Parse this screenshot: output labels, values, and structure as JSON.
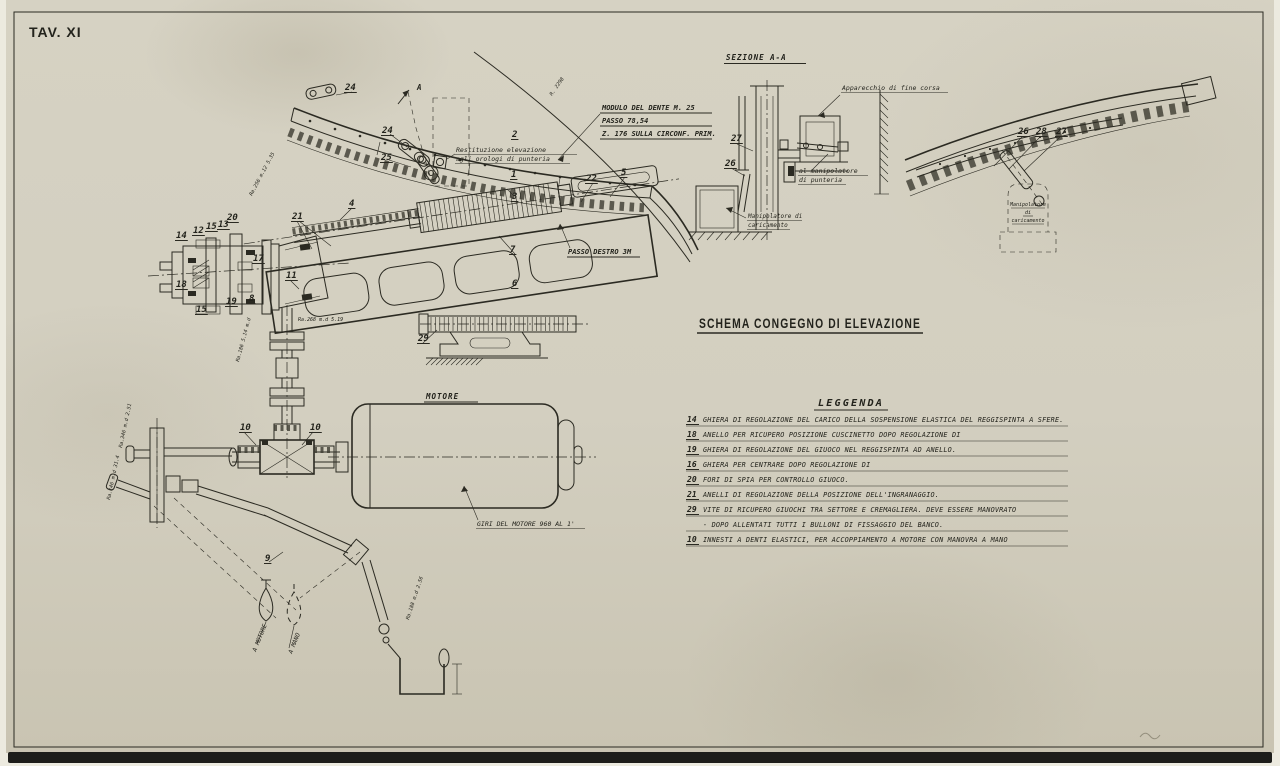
{
  "sheet_label": "TAV. XI",
  "title": "SCHEMA CONGEGNO DI ELEVAZIONE",
  "colors": {
    "paper": "#d3cfc0",
    "ink": "#2b2a22",
    "shadow": "#1d1d1a"
  },
  "gear_notes": {
    "line1": "MODULO DEL DENTE  M. 25",
    "line2": "PASSO 78,54",
    "line3": "Z. 176 SULLA CIRCONF. PRIM.",
    "radius": "R. 2298"
  },
  "labels": {
    "sezione": "SEZIONE A-A",
    "apparecchio": "Apparecchio di fine corsa",
    "al_manipolatore_1": "al manipolatore",
    "al_manipolatore_2": "di punteria",
    "manip_caric_1": "Manipolatore di",
    "manip_caric_2": "caricamento",
    "manip_right_1": "Manipolatore",
    "manip_right_2": "di",
    "manip_right_3": "caricamento",
    "restituzione_1": "Restituzione elevazione",
    "restituzione_2": "agli orologi di punteria",
    "motore": "MOTORE",
    "giri_motore": "GIRI DEL MOTORE 960 AL 1'",
    "passo_destro": "PASSO DESTRO 3M",
    "section_arrow": "A",
    "a_motore": "A MOTORE",
    "a_mano": "A MANO"
  },
  "legend": {
    "heading": "LEGGENDA",
    "items": [
      {
        "num": "14",
        "lines": [
          "GHIERA DI REGOLAZIONE DEL CARICO DELLA SOSPENSIONE ELASTICA DEL REGGISPINTA A SFERE."
        ]
      },
      {
        "num": "18",
        "lines": [
          "ANELLO PER RICUPERO POSIZIONE CUSCINETTO DOPO REGOLAZIONE DI"
        ]
      },
      {
        "num": "19",
        "lines": [
          "GHIERA DI REGOLAZIONE DEL GIUOCO NEL REGGISPINTA AD ANELLO."
        ]
      },
      {
        "num": "16",
        "lines": [
          "GHIERA PER CENTRARE  DOPO REGOLAZIONE DI"
        ]
      },
      {
        "num": "20",
        "lines": [
          "FORI DI SPIA PER CONTROLLO GIUOCO."
        ]
      },
      {
        "num": "21",
        "lines": [
          "ANELLI DI REGOLAZIONE DELLA POSIZIONE DELL'INGRANAGGIO."
        ]
      },
      {
        "num": "29",
        "lines": [
          "VITE DI RICUPERO GIUOCHI TRA SETTORE E CREMAGLIERA. DEVE ESSERE MANOVRATO",
          "- DOPO ALLENTATI TUTTI I BULLONI DI FISSAGGIO DEL BANCO."
        ]
      },
      {
        "num": "10",
        "lines": [
          "INNESTI A DENTI ELASTICI, PER ACCOPPIAMENTO A MOTORE CON MANOVRA A MANO"
        ]
      }
    ]
  },
  "callouts": [
    {
      "n": "24",
      "x": 345,
      "y": 90
    },
    {
      "n": "24",
      "x": 382,
      "y": 133
    },
    {
      "n": "25",
      "x": 381,
      "y": 160
    },
    {
      "n": "2",
      "x": 512,
      "y": 137
    },
    {
      "n": "1",
      "x": 511,
      "y": 177
    },
    {
      "n": "22",
      "x": 586,
      "y": 181
    },
    {
      "n": "5",
      "x": 621,
      "y": 175
    },
    {
      "n": "3",
      "x": 512,
      "y": 199
    },
    {
      "n": "4",
      "x": 349,
      "y": 206
    },
    {
      "n": "7",
      "x": 510,
      "y": 252
    },
    {
      "n": "6",
      "x": 512,
      "y": 286
    },
    {
      "n": "29",
      "x": 418,
      "y": 341
    },
    {
      "n": "14",
      "x": 176,
      "y": 238
    },
    {
      "n": "12",
      "x": 193,
      "y": 233
    },
    {
      "n": "15",
      "x": 206,
      "y": 229
    },
    {
      "n": "13",
      "x": 218,
      "y": 227
    },
    {
      "n": "20",
      "x": 227,
      "y": 220
    },
    {
      "n": "21",
      "x": 292,
      "y": 219
    },
    {
      "n": "17",
      "x": 253,
      "y": 261
    },
    {
      "n": "18",
      "x": 176,
      "y": 287
    },
    {
      "n": "11",
      "x": 286,
      "y": 278
    },
    {
      "n": "19",
      "x": 226,
      "y": 304
    },
    {
      "n": "8",
      "x": 249,
      "y": 301
    },
    {
      "n": "15",
      "x": 196,
      "y": 312
    },
    {
      "n": "10",
      "x": 240,
      "y": 430
    },
    {
      "n": "10",
      "x": 310,
      "y": 430
    },
    {
      "n": "9",
      "x": 265,
      "y": 561
    },
    {
      "n": "27",
      "x": 731,
      "y": 141
    },
    {
      "n": "26",
      "x": 725,
      "y": 166
    },
    {
      "n": "26",
      "x": 1018,
      "y": 134
    },
    {
      "n": "28",
      "x": 1036,
      "y": 134
    },
    {
      "n": "27",
      "x": 1056,
      "y": 134
    }
  ],
  "bearing_refs": [
    {
      "text": "Ra.256 m.12 5.35",
      "x": 252,
      "y": 196,
      "rot": -62
    },
    {
      "text": "Ra.268 m.d 5.19",
      "x": 298,
      "y": 321,
      "rot": 0
    },
    {
      "text": "Ra.186 5.14 m.d",
      "x": 239,
      "y": 362,
      "rot": -75
    },
    {
      "text": "Ra.346 m.d 2.51",
      "x": 122,
      "y": 448,
      "rot": -78
    },
    {
      "text": "Ra.146 m.d 31.4",
      "x": 110,
      "y": 500,
      "rot": -78
    },
    {
      "text": "Ra.188 m.d 2.56",
      "x": 409,
      "y": 620,
      "rot": -72
    }
  ]
}
